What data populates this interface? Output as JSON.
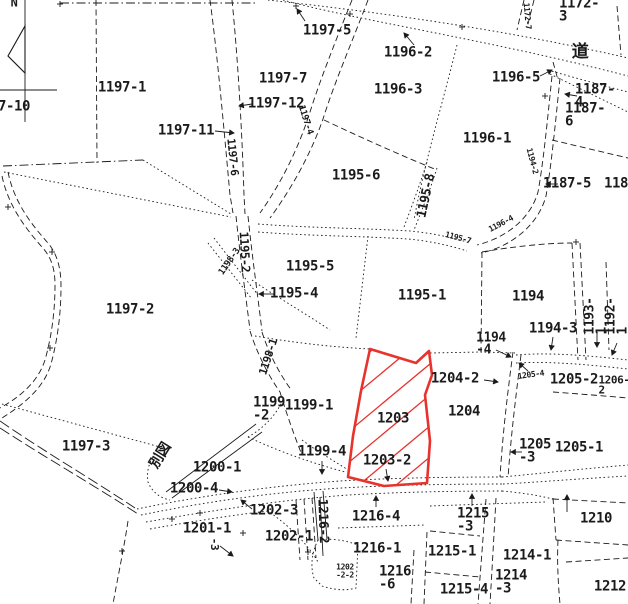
{
  "map": {
    "type": "cadastral-parcel-map",
    "north_indicator": "N",
    "road_kanji": "道",
    "map_reference_kanji": "別図",
    "highlight": {
      "parcel_numbers": [
        "1203",
        "1203-2"
      ],
      "color": "#e8322c",
      "style": "red outline with diagonal hatching"
    },
    "line_color": "#1b1b1b",
    "background_color": "#ffffff",
    "labels": [
      {
        "text": "N",
        "x": 14,
        "y": 3,
        "size": 12,
        "rot": 0,
        "name": "north-label"
      },
      {
        "text": "7-10",
        "x": 14,
        "y": 107,
        "size": 14,
        "rot": 0
      },
      {
        "text": "1197-1",
        "x": 122,
        "y": 88,
        "size": 14,
        "rot": 0
      },
      {
        "text": "1197-11",
        "x": 186,
        "y": 131,
        "size": 14,
        "rot": 0
      },
      {
        "text": "1197-12",
        "x": 276,
        "y": 104,
        "size": 14,
        "rot": 0
      },
      {
        "text": "1197-7",
        "x": 283,
        "y": 79,
        "size": 14,
        "rot": 0
      },
      {
        "text": "1197-5",
        "x": 327,
        "y": 31,
        "size": 14,
        "rot": 0
      },
      {
        "text": "1196-2",
        "x": 408,
        "y": 53,
        "size": 14,
        "rot": 0
      },
      {
        "text": "1196-3",
        "x": 398,
        "y": 90,
        "size": 14,
        "rot": 0
      },
      {
        "text": "1172-3",
        "x": 582,
        "y": 11,
        "size": 14,
        "rot": 0
      },
      {
        "text": "道",
        "x": 580,
        "y": 52,
        "size": 17,
        "rot": 0,
        "name": "road-kanji-label"
      },
      {
        "text": "1172-7",
        "x": 527,
        "y": 16,
        "size": 8,
        "rot": 85
      },
      {
        "text": "1196-5",
        "x": 516,
        "y": 78,
        "size": 14,
        "rot": 0
      },
      {
        "text": "1187-4",
        "x": 595,
        "y": 97,
        "size": 14,
        "rot": 0
      },
      {
        "text": "1187-6",
        "x": 586,
        "y": 116,
        "size": 14,
        "rot": 0
      },
      {
        "text": "1196-1",
        "x": 487,
        "y": 139,
        "size": 14,
        "rot": 0
      },
      {
        "text": "1195-6",
        "x": 356,
        "y": 176,
        "size": 14,
        "rot": 0
      },
      {
        "text": "1195-8",
        "x": 427,
        "y": 196,
        "size": 13,
        "rot": -78
      },
      {
        "text": "1187-5",
        "x": 567,
        "y": 184,
        "size": 14,
        "rot": 0
      },
      {
        "text": "1187",
        "x": 620,
        "y": 184,
        "size": 14,
        "rot": 0
      },
      {
        "text": "1197-6",
        "x": 232,
        "y": 157,
        "size": 11,
        "rot": 84
      },
      {
        "text": "1197-4",
        "x": 305,
        "y": 120,
        "size": 9,
        "rot": 72
      },
      {
        "text": "1195-5",
        "x": 310,
        "y": 267,
        "size": 14,
        "rot": 0
      },
      {
        "text": "1195-4",
        "x": 294,
        "y": 294,
        "size": 14,
        "rot": 0
      },
      {
        "text": "1195-2",
        "x": 244,
        "y": 252,
        "size": 12,
        "rot": 87
      },
      {
        "text": "1198-3",
        "x": 230,
        "y": 262,
        "size": 9,
        "rot": -55
      },
      {
        "text": "1195-7",
        "x": 458,
        "y": 238,
        "size": 8,
        "rot": 15
      },
      {
        "text": "1196-4",
        "x": 501,
        "y": 224,
        "size": 8,
        "rot": -28
      },
      {
        "text": "1194-2",
        "x": 532,
        "y": 161,
        "size": 8,
        "rot": 75
      },
      {
        "text": "1195-1",
        "x": 422,
        "y": 296,
        "size": 14,
        "rot": 0
      },
      {
        "text": "1194",
        "x": 528,
        "y": 297,
        "size": 14,
        "rot": 0
      },
      {
        "text": "1194-3",
        "x": 553,
        "y": 329,
        "size": 14,
        "rot": 0
      },
      {
        "text": "1193-1",
        "x": 597,
        "y": 316,
        "size": 13,
        "rot": -90
      },
      {
        "text": "1192-1",
        "x": 618,
        "y": 316,
        "size": 13,
        "rot": -90
      },
      {
        "text": "1194\n-4",
        "x": 491,
        "y": 345,
        "size": 13,
        "rot": 0
      },
      {
        "text": "1197-2",
        "x": 130,
        "y": 310,
        "size": 14,
        "rot": 0
      },
      {
        "text": "1198-1",
        "x": 269,
        "y": 357,
        "size": 11,
        "rot": -72
      },
      {
        "text": "1199\n-2",
        "x": 269,
        "y": 410,
        "size": 14,
        "rot": 0
      },
      {
        "text": "1199-1",
        "x": 309,
        "y": 406,
        "size": 14,
        "rot": 0
      },
      {
        "text": "1199-4",
        "x": 322,
        "y": 452,
        "size": 14,
        "rot": 0
      },
      {
        "text": "1200-1",
        "x": 217,
        "y": 468,
        "size": 14,
        "rot": 0
      },
      {
        "text": "1200-4",
        "x": 194,
        "y": 489,
        "size": 14,
        "rot": 0
      },
      {
        "text": "1202-3",
        "x": 274,
        "y": 511,
        "size": 14,
        "rot": 0
      },
      {
        "text": "1201-1",
        "x": 207,
        "y": 529,
        "size": 14,
        "rot": 0
      },
      {
        "text": "-3",
        "x": 214,
        "y": 544,
        "size": 11,
        "rot": 90
      },
      {
        "text": "1202-1",
        "x": 289,
        "y": 537,
        "size": 14,
        "rot": 0
      },
      {
        "text": "1216-2",
        "x": 322,
        "y": 521,
        "size": 13,
        "rot": 88
      },
      {
        "text": "1197-3",
        "x": 86,
        "y": 447,
        "size": 14,
        "rot": 0
      },
      {
        "text": "別図",
        "x": 161,
        "y": 456,
        "size": 14,
        "rot": -58,
        "name": "map-reference-label"
      },
      {
        "text": "1216-4",
        "x": 376,
        "y": 517,
        "size": 14,
        "rot": 0
      },
      {
        "text": "1216-1",
        "x": 377,
        "y": 549,
        "size": 14,
        "rot": 0
      },
      {
        "text": "1216\n-6",
        "x": 395,
        "y": 579,
        "size": 14,
        "rot": 0
      },
      {
        "text": "1202\n-2-2",
        "x": 345,
        "y": 571,
        "size": 8,
        "rot": 0
      },
      {
        "text": "1215\n-3",
        "x": 473,
        "y": 521,
        "size": 14,
        "rot": 0
      },
      {
        "text": "1215-1",
        "x": 452,
        "y": 552,
        "size": 14,
        "rot": 0
      },
      {
        "text": "1215-4",
        "x": 464,
        "y": 590,
        "size": 14,
        "rot": 0
      },
      {
        "text": "1214-1",
        "x": 527,
        "y": 556,
        "size": 14,
        "rot": 0
      },
      {
        "text": "1214\n-3",
        "x": 511,
        "y": 583,
        "size": 14,
        "rot": 0
      },
      {
        "text": "1210",
        "x": 596,
        "y": 519,
        "size": 14,
        "rot": 0
      },
      {
        "text": "1212-",
        "x": 614,
        "y": 587,
        "size": 14,
        "rot": 0
      },
      {
        "text": "1205\n-3",
        "x": 535,
        "y": 452,
        "size": 14,
        "rot": 0
      },
      {
        "text": "1205-1",
        "x": 579,
        "y": 448,
        "size": 14,
        "rot": 0
      },
      {
        "text": "1205-2",
        "x": 574,
        "y": 380,
        "size": 14,
        "rot": 0
      },
      {
        "text": "1206-2",
        "x": 614,
        "y": 386,
        "size": 11,
        "rot": 0
      },
      {
        "text": "1205-4",
        "x": 531,
        "y": 375,
        "size": 8,
        "rot": -8
      },
      {
        "text": "1204-2",
        "x": 455,
        "y": 379,
        "size": 14,
        "rot": 0
      },
      {
        "text": "1204",
        "x": 464,
        "y": 412,
        "size": 14,
        "rot": 0
      },
      {
        "text": "1203",
        "x": 393,
        "y": 419,
        "size": 14,
        "rot": 0
      },
      {
        "text": "1203-2",
        "x": 387,
        "y": 461,
        "size": 14,
        "rot": 0
      }
    ]
  }
}
